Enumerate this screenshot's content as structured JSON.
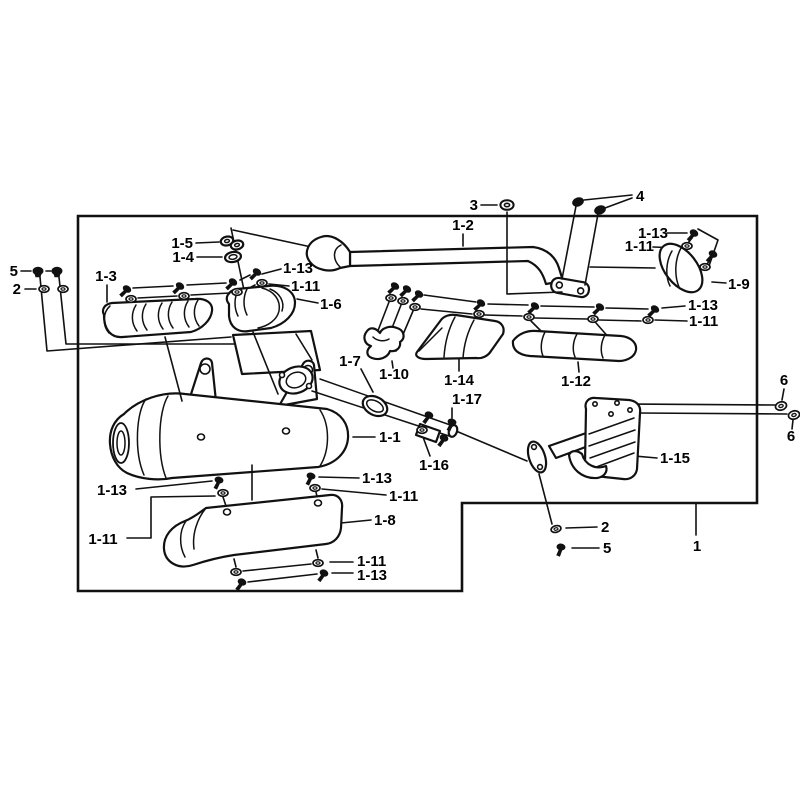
{
  "figure": {
    "type": "exploded-parts-diagram",
    "subject": "exhaust muffler assembly",
    "background_color": "#ffffff",
    "line_color": "#111111",
    "callout_numbers": [
      "1",
      "2",
      "3",
      "4",
      "5",
      "6",
      "1-1",
      "1-2",
      "1-3",
      "1-4",
      "1-5",
      "1-6",
      "1-7",
      "1-8",
      "1-9",
      "1-10",
      "1-11",
      "1-12",
      "1-13",
      "1-14",
      "1-15",
      "1-16",
      "1-17"
    ],
    "labels": [
      {
        "id": "bolt-5-left",
        "text": "5"
      },
      {
        "id": "washer-2-left",
        "text": "2"
      },
      {
        "id": "gasket-1-5",
        "text": "1-5"
      },
      {
        "id": "gasket-1-4",
        "text": "1-4"
      },
      {
        "id": "shield-1-3",
        "text": "1-3"
      },
      {
        "id": "screw-1-13-a",
        "text": "1-13"
      },
      {
        "id": "washer-1-11-a",
        "text": "1-11"
      },
      {
        "id": "shield-1-6",
        "text": "1-6"
      },
      {
        "id": "ring-3",
        "text": "3"
      },
      {
        "id": "pipe-1-2",
        "text": "1-2"
      },
      {
        "id": "bolts-4",
        "text": "4"
      },
      {
        "id": "screw-1-13-b",
        "text": "1-13"
      },
      {
        "id": "washer-1-11-b",
        "text": "1-11"
      },
      {
        "id": "cover-1-9",
        "text": "1-9"
      },
      {
        "id": "screw-1-13-c",
        "text": "1-13"
      },
      {
        "id": "washer-1-11-c",
        "text": "1-11"
      },
      {
        "id": "clamp-1-7",
        "text": "1-7"
      },
      {
        "id": "bracket-1-10",
        "text": "1-10"
      },
      {
        "id": "shield-1-14",
        "text": "1-14"
      },
      {
        "id": "shield-1-12",
        "text": "1-12"
      },
      {
        "id": "bolt-1-17",
        "text": "1-17"
      },
      {
        "id": "muffler-1-1",
        "text": "1-1"
      },
      {
        "id": "pipe-1-16",
        "text": "1-16"
      },
      {
        "id": "stay-1-15",
        "text": "1-15"
      },
      {
        "id": "ring-6-upper",
        "text": "6"
      },
      {
        "id": "ring-6-lower",
        "text": "6"
      },
      {
        "id": "screw-1-13-d",
        "text": "1-13"
      },
      {
        "id": "washer-1-11-d",
        "text": "1-11"
      },
      {
        "id": "screw-1-13-e",
        "text": "1-13"
      },
      {
        "id": "washer-1-11-e",
        "text": "1-11"
      },
      {
        "id": "shield-1-8",
        "text": "1-8"
      },
      {
        "id": "washer-1-11-f",
        "text": "1-11"
      },
      {
        "id": "screw-1-13-f",
        "text": "1-13"
      },
      {
        "id": "washer-2-right",
        "text": "2"
      },
      {
        "id": "screw-5-right",
        "text": "5"
      },
      {
        "id": "assembly-1",
        "text": "1"
      }
    ]
  }
}
